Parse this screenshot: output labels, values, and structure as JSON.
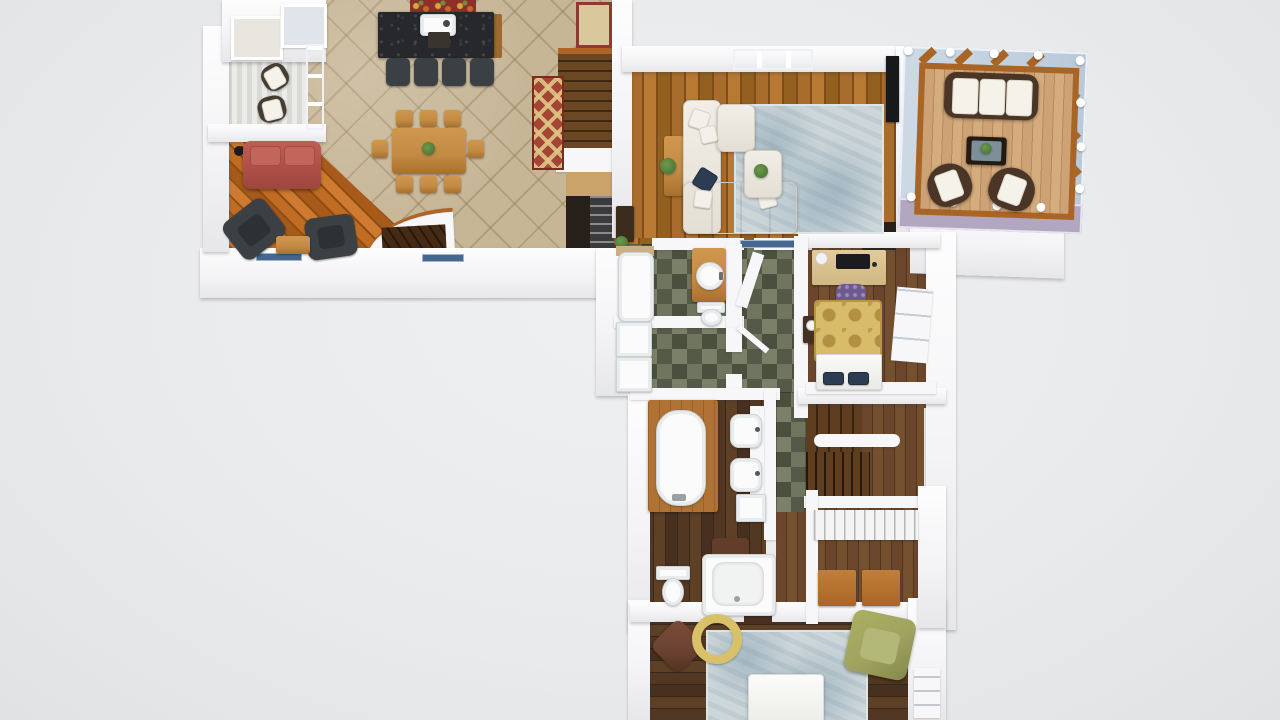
{
  "scene": {
    "width": 1280,
    "height": 720,
    "view": "3d-top-down-floor-plan"
  },
  "palette": {
    "background": "#e8eaec",
    "wall": "#f7f7f9",
    "tile": "#c7b696",
    "wood_family": "#b5651d",
    "wood_living": "#9a6527",
    "wood_dark": "#4b3322",
    "wood_mid": "#64412a",
    "wood_deck": "#c79e6f",
    "deck_frame": "#a96526",
    "stair_wood": "#563619",
    "slate": "#5e6254",
    "rug_blue": "#cdd7da",
    "rug_gold": "#d8bc69",
    "runner_red": "#a34434",
    "rug_floral": "#8e2f2c",
    "mat_tan": "#d8c89c",
    "sofa_red": "#b2524a",
    "sofa_cream": "#ebe8e0",
    "armchair_dark": "#3b4045",
    "chair_green": "#9fa35f",
    "pouf_brown": "#6b4231",
    "granite": "#26282b",
    "wood_furniture": "#c28a44",
    "glass": "#c4d3e2",
    "glass_purple": "#b2a7c0",
    "pillow_navy": "#2c3c52",
    "chair_purple": "#6e5a8e",
    "plant_green": "#4e7a3a",
    "fixture_white": "#fbfbfc"
  },
  "inventory": {
    "porch": [
      "2 rocking chairs",
      "striped plank floor"
    ],
    "kitchen": [
      "granite island with sink",
      "4 bar stools",
      "floral rug",
      "door mat",
      "tile floor"
    ],
    "dining_area": [
      "dining table",
      "8 dining chairs",
      "runner rug"
    ],
    "family_room": [
      "red sofa",
      "2 dark armchairs",
      "coffee table",
      "floor lamp",
      "diagonal wood floor"
    ],
    "stair_hall": [
      "staircase up",
      "stairwell shelves",
      "basement stairs with curved railing"
    ],
    "living_room": [
      "cream sectional sofa",
      "ottoman with plant",
      "side table with plant",
      "blue area rug",
      "wall tv",
      "dark cabinet"
    ],
    "sunroom": [
      "wicker sofa",
      "coffee table with plant",
      "2 wicker chairs",
      "deck floor",
      "screen posts"
    ],
    "hall_bathroom": [
      "bathtub",
      "vanity with round sink",
      "toilet",
      "washer and dryer",
      "slate tile floor"
    ],
    "bedroom": [
      "desk with laptop and lamp",
      "purple office chair",
      "bed with gold duvet",
      "2 navy pillows",
      "nightstand with clock",
      "open window"
    ],
    "master_bathroom": [
      "freestanding tub on platform",
      "2 vessel sinks",
      "shower",
      "toilet",
      "brown bath mat"
    ],
    "walk_in_closet": [
      "cubby shelf unit",
      "2 wood dressers"
    ],
    "master_bedroom": [
      "bed",
      "blue area rug",
      "green accent chair",
      "brown pouf",
      "round yellow cushion",
      "corner window"
    ]
  }
}
